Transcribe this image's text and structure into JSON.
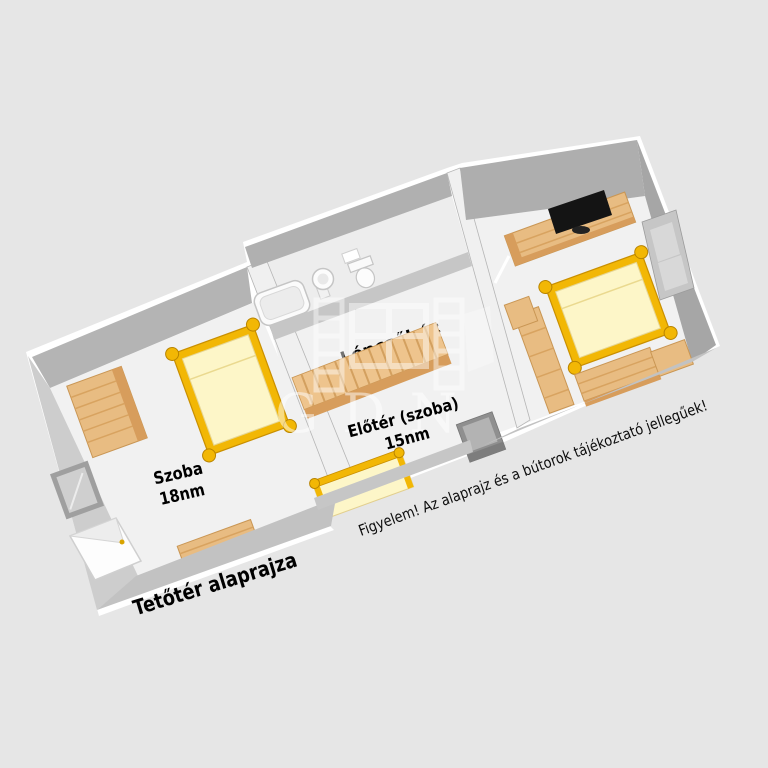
{
  "plan": {
    "title": "Tetőtér alaprajza",
    "disclaimer": "Figyelem! Az alaprajz és a bútorok tájékoztató jellegűek!",
    "watermark": "GDN",
    "rooms": [
      {
        "label": "Szoba",
        "area": "18nm"
      },
      {
        "label": "Előtér (szoba)",
        "area": "15nm"
      },
      {
        "label": "Lépcsőház"
      }
    ],
    "colors": {
      "background": "#e6e6e6",
      "floor": "#f1f1f1",
      "wall_face": "#b5b5b5",
      "wall_dark": "#a6a6a6",
      "wood_furniture": "#e8bc82",
      "wood_dark": "#d79d5c",
      "bed_frame_gold": "#f2b705",
      "mattress": "#fdf6c8",
      "tv_black": "#141414",
      "watermark_white": "#ffffff"
    }
  }
}
